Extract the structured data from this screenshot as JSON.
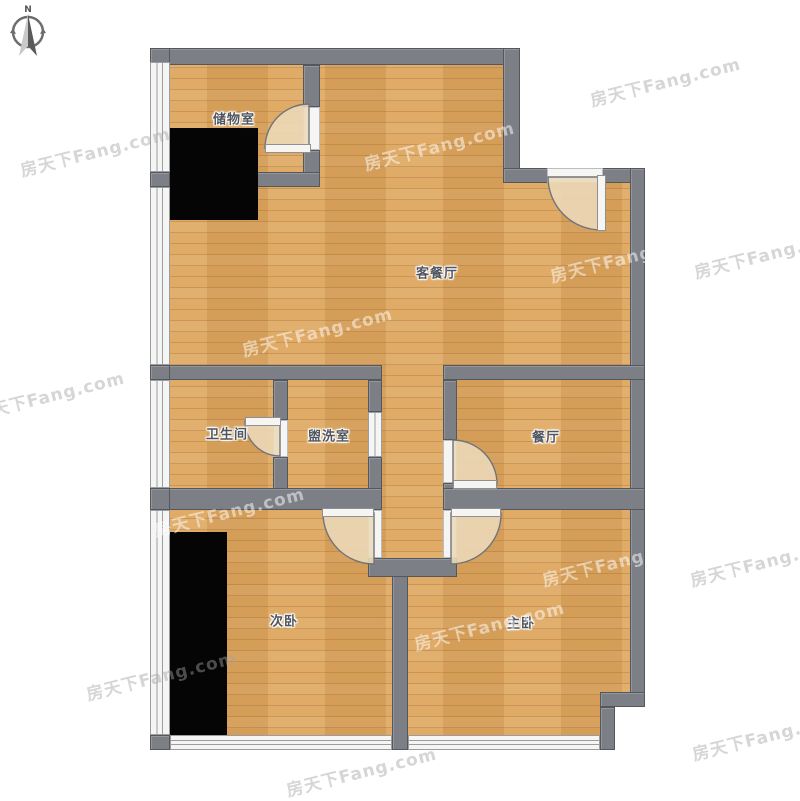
{
  "title": "户型图",
  "compass": {
    "label": "N"
  },
  "watermark": {
    "text": "房天下Fang.com"
  },
  "rooms": {
    "storage": {
      "label": "储物室"
    },
    "living_dining": {
      "label": "客餐厅"
    },
    "bathroom": {
      "label": "卫生间"
    },
    "washroom": {
      "label": "盥洗室"
    },
    "dining": {
      "label": "餐厅"
    },
    "secondary_bedroom": {
      "label": "次卧"
    },
    "master_bedroom": {
      "label": "主卧"
    }
  },
  "fixtures": {
    "doors": [
      "storage-door",
      "entrance-door",
      "bathroom-door",
      "dining-door",
      "secondary-bedroom-door",
      "master-bedroom-door"
    ],
    "windows": [
      "left-window-1",
      "left-window-2",
      "left-window-3",
      "left-window-4",
      "secondary-bedroom-bottom-window",
      "master-bedroom-bottom-window",
      "washroom-sliding-door"
    ],
    "furniture": [
      "storage-wardrobe",
      "secondary-bedroom-wardrobe"
    ]
  },
  "colors": {
    "floor": "#dda65e",
    "wall": "#7c8086",
    "wall_border": "#54575c",
    "door_arc_fill": "#ecd9b8",
    "window": "#f5f5f3",
    "furniture": "#050505",
    "label": "#50555e"
  },
  "watermarks": [
    {
      "x": 18,
      "y": 138,
      "tone": "gray"
    },
    {
      "x": 362,
      "y": 132,
      "tone": "light"
    },
    {
      "x": 588,
      "y": 68,
      "tone": "gray"
    },
    {
      "x": -28,
      "y": 382,
      "tone": "gray"
    },
    {
      "x": 240,
      "y": 318,
      "tone": "light"
    },
    {
      "x": 548,
      "y": 244,
      "tone": "light"
    },
    {
      "x": 692,
      "y": 240,
      "tone": "gray"
    },
    {
      "x": 152,
      "y": 498,
      "tone": "light"
    },
    {
      "x": 540,
      "y": 548,
      "tone": "light"
    },
    {
      "x": 688,
      "y": 548,
      "tone": "gray"
    },
    {
      "x": 412,
      "y": 612,
      "tone": "light"
    },
    {
      "x": 84,
      "y": 662,
      "tone": "gray"
    },
    {
      "x": 284,
      "y": 758,
      "tone": "gray"
    },
    {
      "x": 690,
      "y": 722,
      "tone": "gray"
    }
  ]
}
